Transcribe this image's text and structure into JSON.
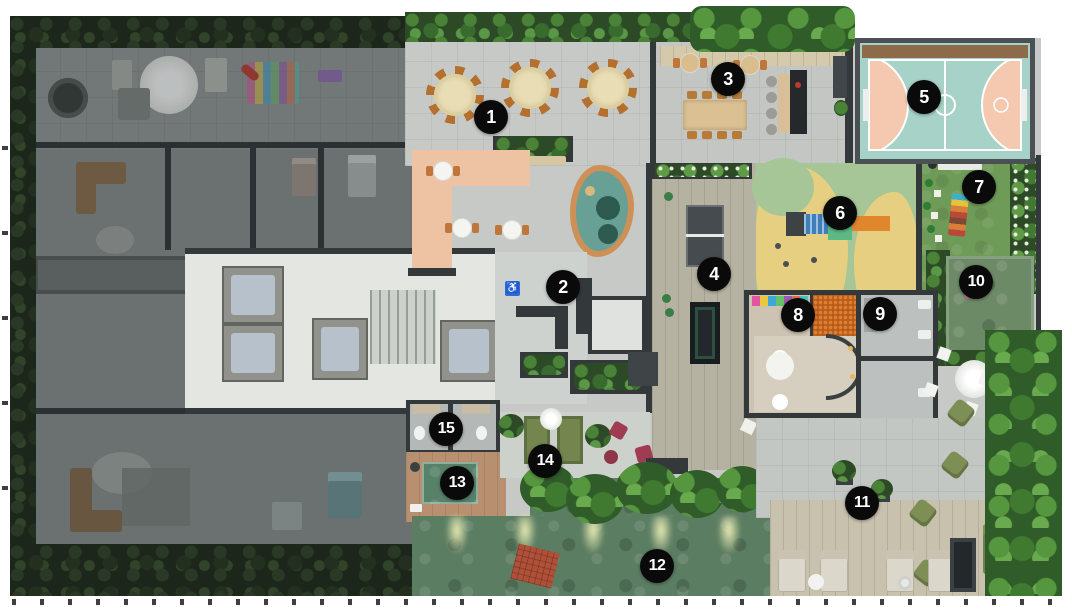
{
  "icons": {
    "accessible": "♿"
  },
  "plan": {
    "type": "residential-amenity-floorplan-top-view",
    "marker_style": {
      "bg": "#0a0a0a",
      "fg": "#ffffff",
      "diameter_px": 34
    },
    "markers": [
      {
        "label": "1",
        "x": 491,
        "y": 117
      },
      {
        "label": "2",
        "x": 563,
        "y": 287
      },
      {
        "label": "3",
        "x": 728,
        "y": 79
      },
      {
        "label": "4",
        "x": 714,
        "y": 274
      },
      {
        "label": "5",
        "x": 924,
        "y": 97
      },
      {
        "label": "6",
        "x": 840,
        "y": 213
      },
      {
        "label": "7",
        "x": 979,
        "y": 187
      },
      {
        "label": "8",
        "x": 798,
        "y": 315
      },
      {
        "label": "9",
        "x": 880,
        "y": 314
      },
      {
        "label": "10",
        "x": 976,
        "y": 282
      },
      {
        "label": "11",
        "x": 862,
        "y": 503
      },
      {
        "label": "12",
        "x": 657,
        "y": 566
      },
      {
        "label": "13",
        "x": 457,
        "y": 483
      },
      {
        "label": "14",
        "x": 545,
        "y": 461
      },
      {
        "label": "15",
        "x": 446,
        "y": 429
      }
    ],
    "colors": {
      "court_teal": "#a7d2c8",
      "court_salmon": "#f4c9b0",
      "court_frame": "#4a5053",
      "lawn_green": "#6f9b58",
      "pool_water": "#5b7d62",
      "playground_green": "#a6c697",
      "playground_yellow": "#e6cf80",
      "cafe_salmon": "#eec3a4",
      "ballpit_orange": "#cd6a24",
      "deck_wood": "#c8c1ae",
      "spa_deck": "#b8906f",
      "dim_floor": "#868b89",
      "bright_floor": "#e3e6e1",
      "wall_dark": "#33383b",
      "vegetation": "#2f5c28"
    }
  }
}
